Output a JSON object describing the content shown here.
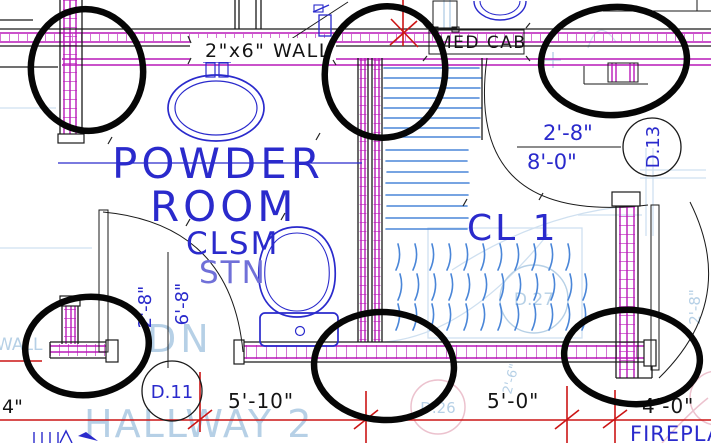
{
  "plan": {
    "notes": {
      "wall_note": "2\"x6\" WALL",
      "med_cab": "MED CAB"
    },
    "rooms": {
      "powder_line1": "POWDER",
      "powder_line2": "ROOM",
      "powder_sub1": "CLSM",
      "powder_sub2": "STN",
      "closet": "CL 1",
      "fireplace": "FIREPLACE"
    },
    "door_tags": {
      "d11": "D.11",
      "d13": "D.13"
    },
    "dimensions": {
      "d13_width": "2'-8\"",
      "d13_height": "8'-0\"",
      "d11_width": "2'-8\"",
      "d11_height": "6'-8\"",
      "left_partial": "4\"",
      "bottom_left": "5'-10\"",
      "bottom_middle": "5'-0\"",
      "bottom_right": "4'-0\""
    },
    "ghost_layer": {
      "down_label": "DN",
      "hallway": "HALLWAY 2",
      "left_wall_text": "WALL",
      "tag_d26": "D.26",
      "tag_d27": "D.27",
      "dim_right": "2'-8\"",
      "dim_bottom": "2'-6\""
    },
    "colors": {
      "wall_magenta": "#b818b8",
      "drawing_blue": "#2a2acc",
      "ghost_blue": "#b6d0e6",
      "ghost_pink": "#ecc2ce",
      "stair_hatch_blue": "#4a86d8",
      "dimension_red": "#cc1515",
      "marker_black": "#060606"
    }
  }
}
